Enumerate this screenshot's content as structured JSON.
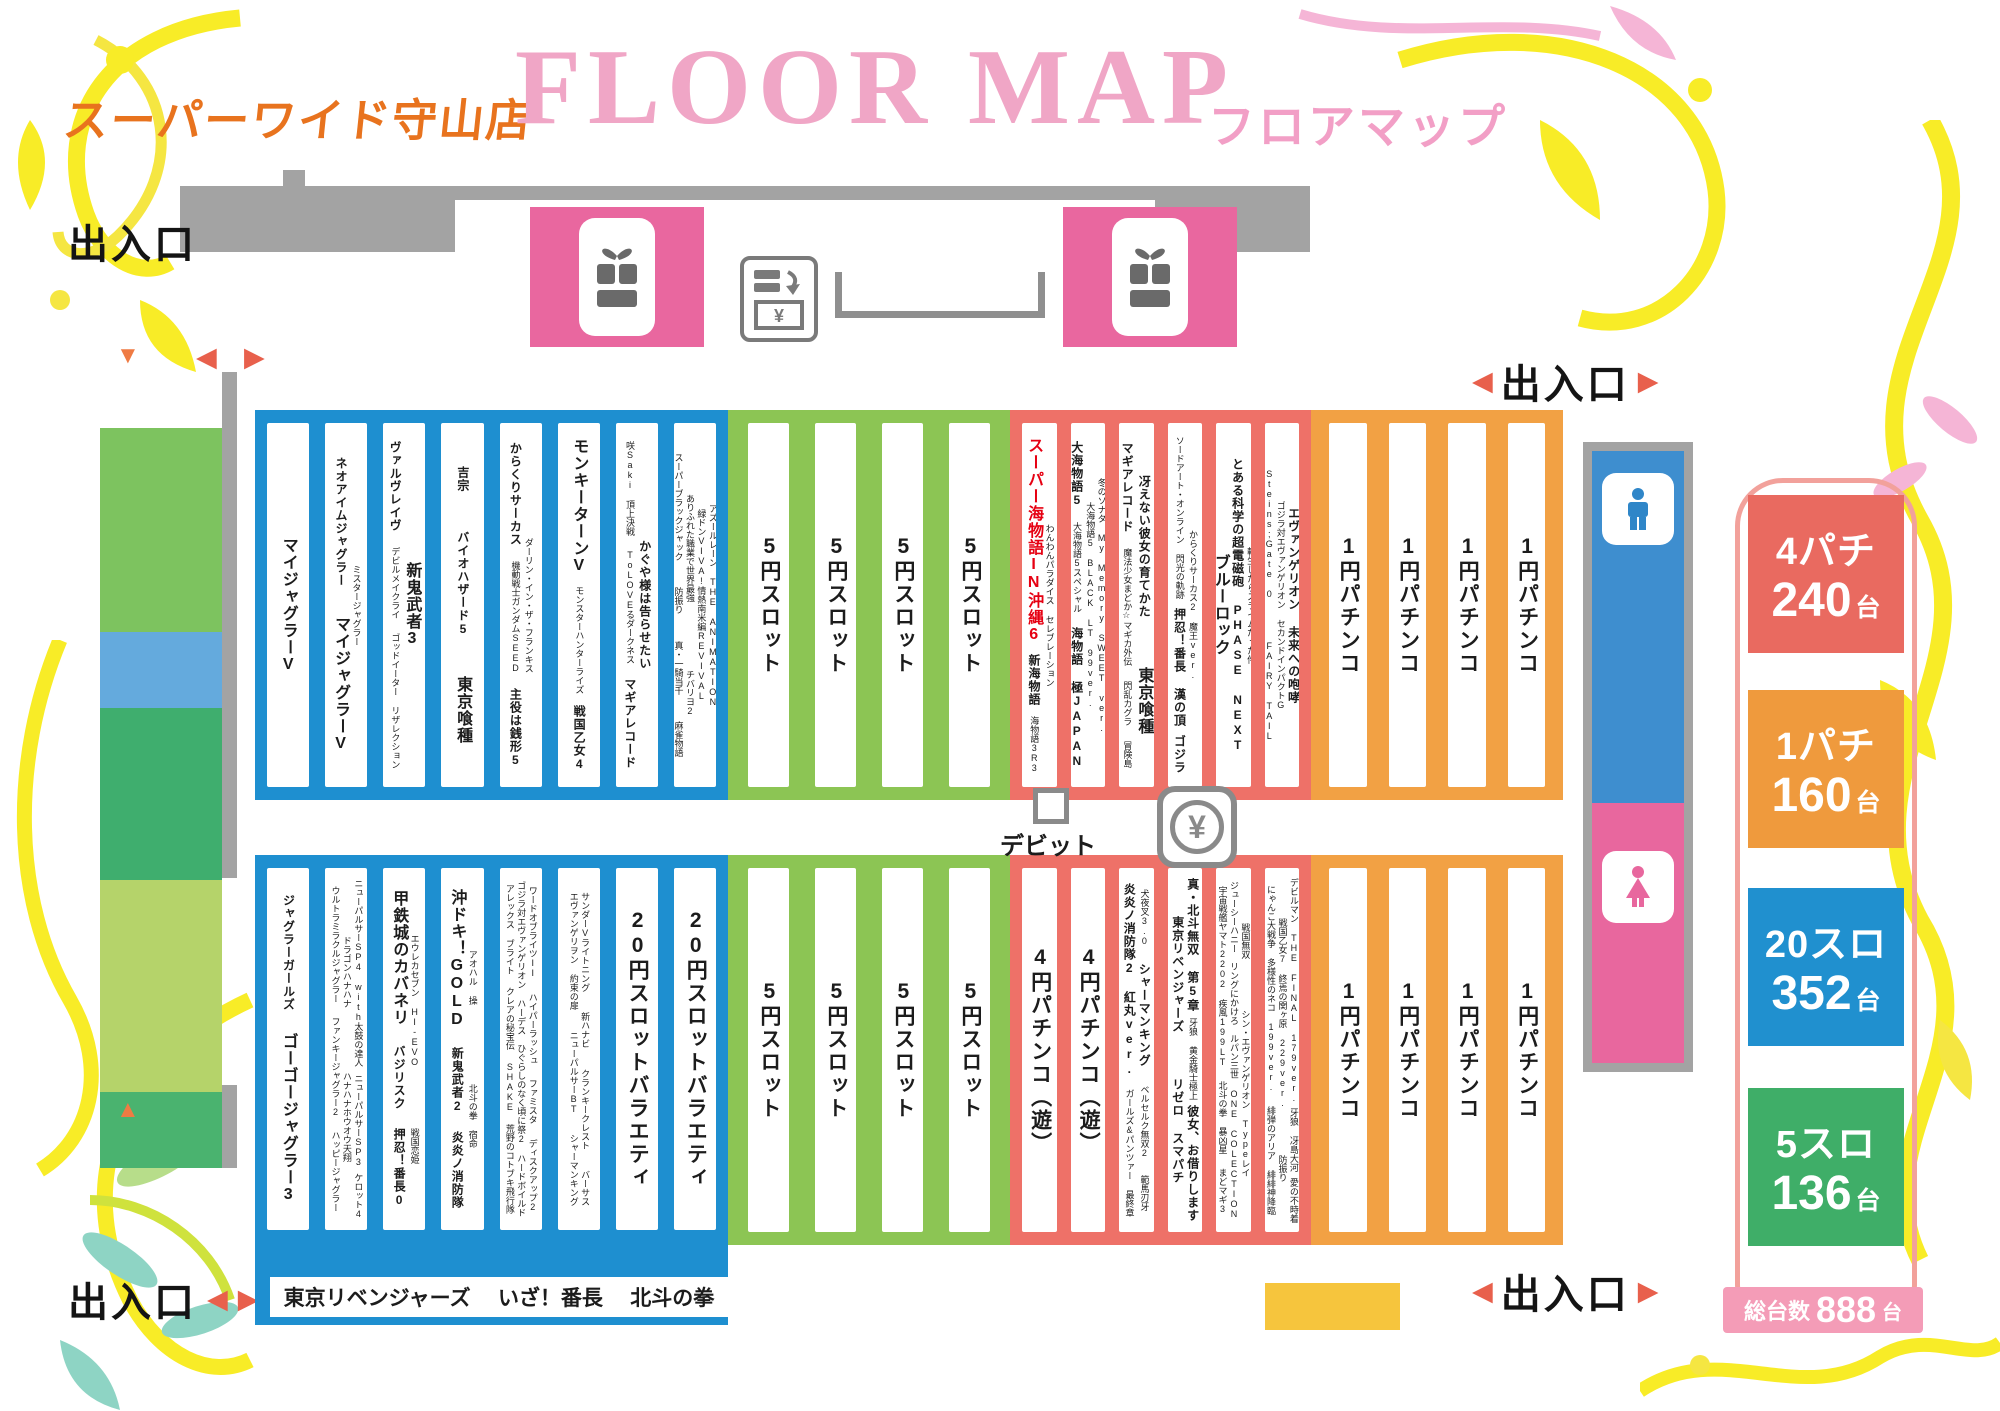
{
  "header": {
    "store": "スーパーワイド守山店",
    "title_en": "FLOOR MAP",
    "title_jp": "フロアマップ"
  },
  "labels": {
    "exit": "出入口",
    "debit": "デビット",
    "yen": "¥",
    "tri_left": "◀",
    "tri_right": "▶",
    "tri_up": "▲",
    "tri_down": "▼"
  },
  "colors": {
    "slot20": "#1e8fd0",
    "slot5": "#8cc554",
    "pachi4": "#ee7168",
    "pachi1": "#f2a144",
    "pink": "#e9679f",
    "wall": "#a3a3a3",
    "accent_red": "#e60012"
  },
  "bottom_strip": {
    "labels": [
      "東京リベンジャーズ",
      "いざ！番長",
      "北斗の拳"
    ]
  },
  "legend": {
    "items": [
      {
        "label": "4パチ",
        "count": "240",
        "unit": "台",
        "color": "#e96a60",
        "y": 495
      },
      {
        "label": "1パチ",
        "count": "160",
        "unit": "台",
        "color": "#ef9a3d",
        "y": 690
      },
      {
        "label": "20スロ",
        "count": "352",
        "unit": "台",
        "color": "#2090cf",
        "y": 888
      },
      {
        "label": "5スロ",
        "count": "136",
        "unit": "台",
        "color": "#3fae68",
        "y": 1088
      }
    ],
    "total_label": "総台数",
    "total_count": "888",
    "total_unit": "台"
  },
  "sections": [
    {
      "id": "slot20-top",
      "color": "#1e8fd0",
      "x": 255,
      "y": 410,
      "w": 473,
      "h": 390,
      "gap": 16,
      "px": 12,
      "columns": [
        [
          {
            "t": "マイジャグラーV",
            "s": "L"
          }
        ],
        [
          {
            "t": "ネオアイムジャグラー",
            "s": "M"
          },
          {
            "t": "マイジャグラーV",
            "s": "L"
          },
          {
            "t": "ミスタージャグラー",
            "s": "S"
          }
        ],
        [
          {
            "t": "ヴァルヴレイヴ",
            "s": "M"
          },
          {
            "t": "デビルメイクライ",
            "s": "S"
          },
          {
            "t": "ゴッドイーター リザレクション",
            "s": "S"
          },
          {
            "t": "新鬼武者3",
            "s": "L"
          }
        ],
        [
          {
            "t": "吉宗",
            "s": "M"
          },
          {
            "t": "バイオハザード5",
            "s": "M"
          },
          {
            "t": "東京喰種",
            "s": "L"
          }
        ],
        [
          {
            "t": "からくりサーカス",
            "s": "M"
          },
          {
            "t": "機動戦士ガンダムSEED",
            "s": "S"
          },
          {
            "t": "主役は銭形5",
            "s": "M"
          },
          {
            "t": "ダーリン・イン・ザ・フランキス",
            "s": "S"
          }
        ],
        [
          {
            "t": "モンキーターンV",
            "s": "L"
          },
          {
            "t": "モンスターハンターライズ",
            "s": "S"
          },
          {
            "t": "戦国乙女4",
            "s": "M"
          }
        ],
        [
          {
            "t": "咲Saki 頂上決戦",
            "s": "S"
          },
          {
            "t": "ToLOVEるダークネス",
            "s": "S"
          },
          {
            "t": "マギアレコード",
            "s": "M"
          },
          {
            "t": "かぐや様は告らせたい",
            "s": "M"
          }
        ],
        [
          {
            "t": "スーパーブラックジャック",
            "s": "S"
          },
          {
            "t": "防振り",
            "s": "S"
          },
          {
            "t": "真・一騎当千",
            "s": "S"
          },
          {
            "t": "麻雀物語",
            "s": "S"
          },
          {
            "t": "ありふれた職業で世界最強",
            "s": "S"
          },
          {
            "t": "チバリヨ2",
            "s": "S"
          },
          {
            "t": "緑ドンVIVA!情熱南米編REVIVAL",
            "s": "S"
          },
          {
            "t": "アズールレーン THE ANIMATION",
            "s": "S"
          }
        ]
      ]
    },
    {
      "id": "slot5-top",
      "color": "#8cc554",
      "x": 728,
      "y": 410,
      "w": 282,
      "h": 390,
      "gap": 26,
      "px": 20,
      "columns": [
        [
          {
            "t": "5円スロット",
            "s": "XL"
          }
        ],
        [
          {
            "t": "5円スロット",
            "s": "XL"
          }
        ],
        [
          {
            "t": "5円スロット",
            "s": "XL"
          }
        ],
        [
          {
            "t": "5円スロット",
            "s": "XL"
          }
        ]
      ]
    },
    {
      "id": "pachi4-top",
      "color": "#ee7168",
      "x": 1010,
      "y": 410,
      "w": 301,
      "h": 390,
      "gap": 14,
      "px": 12,
      "columns": [
        [
          {
            "t": "スーパー海物語IN沖縄6",
            "s": "L",
            "c": "#e60012"
          },
          {
            "t": "新海物語",
            "s": "M"
          },
          {
            "t": "海物語3R3",
            "s": "S"
          },
          {
            "t": "わんわんパラダイス セレブレーション",
            "s": "S"
          }
        ],
        [
          {
            "t": "大海物語5",
            "s": "M"
          },
          {
            "t": "大海物語5スペシャル",
            "s": "S"
          },
          {
            "t": "海物語 極JAPAN",
            "s": "M"
          },
          {
            "t": "大海物語5 BLACK LT 99ver.",
            "s": "S"
          },
          {
            "t": "冬のソナタ My Memory SWEET ver.",
            "s": "S"
          }
        ],
        [
          {
            "t": "マギアレコード",
            "s": "M"
          },
          {
            "t": "魔法少女まどか☆マギカ外伝",
            "s": "S"
          },
          {
            "t": "閃乱カグラ",
            "s": "S"
          },
          {
            "t": "冒険島",
            "s": "S"
          },
          {
            "t": "冴えない彼女の育てかた",
            "s": "M"
          },
          {
            "t": "東京喰種",
            "s": "L"
          }
        ],
        [
          {
            "t": "ソードアート・オンライン 閃光の軌跡",
            "s": "S"
          },
          {
            "t": "押忍！番長 漢の頂",
            "s": "M"
          },
          {
            "t": "ゴジラ",
            "s": "M"
          },
          {
            "t": "からくりサーカス2 魔王ver.",
            "s": "S"
          }
        ],
        [
          {
            "t": "ブルーロック",
            "s": "L"
          },
          {
            "t": "とある科学の超電磁砲 PHASE NEXT",
            "s": "M"
          },
          {
            "t": "転生したらスライムだった件",
            "s": "S"
          }
        ],
        [
          {
            "t": "Steins;Gate 0",
            "s": "S"
          },
          {
            "t": "FAIRY TAIL",
            "s": "S"
          },
          {
            "t": "ゴジラ対エヴァンゲリオン セカンドインパクトG",
            "s": "S"
          },
          {
            "t": "エヴァンゲリオン 未来への咆哮",
            "s": "M"
          }
        ]
      ]
    },
    {
      "id": "pachi1-top",
      "color": "#f2a144",
      "x": 1311,
      "y": 410,
      "w": 252,
      "h": 390,
      "gap": 22,
      "px": 18,
      "columns": [
        [
          {
            "t": "1円パチンコ",
            "s": "XL"
          }
        ],
        [
          {
            "t": "1円パチンコ",
            "s": "XL"
          }
        ],
        [
          {
            "t": "1円パチンコ",
            "s": "XL"
          }
        ],
        [
          {
            "t": "1円パチンコ",
            "s": "XL"
          }
        ]
      ]
    },
    {
      "id": "slot20-bottom",
      "color": "#1e8fd0",
      "x": 255,
      "y": 855,
      "w": 473,
      "h": 470,
      "gap": 16,
      "px": 12,
      "pb": 95,
      "columns": [
        [
          {
            "t": "ジャグラーガールズ",
            "s": "M"
          },
          {
            "t": "ゴーゴージャグラー3",
            "s": "L"
          }
        ],
        [
          {
            "t": "ウルトラミラクルジャグラー",
            "s": "S"
          },
          {
            "t": "ファンキージャグラー2",
            "s": "S"
          },
          {
            "t": "ハッピージャグラー",
            "s": "S"
          },
          {
            "t": "ドラゴンハナハナ",
            "s": "S"
          },
          {
            "t": "ハナハナホウオウ天翔",
            "s": "S"
          },
          {
            "t": "ニューパルサーSP4 with太鼓の達人",
            "s": "S"
          },
          {
            "t": "ニューパルサーSP3",
            "s": "S"
          },
          {
            "t": "ケロット4",
            "s": "S"
          }
        ],
        [
          {
            "t": "甲鉄城のカバネリ",
            "s": "L"
          },
          {
            "t": "バジリスク",
            "s": "M"
          },
          {
            "t": "押忍！番長0",
            "s": "M"
          },
          {
            "t": "エウレカセブン HI-EVO",
            "s": "S"
          },
          {
            "t": "戦国恋姫",
            "s": "S"
          }
        ],
        [
          {
            "t": "沖ドキ！GOLD",
            "s": "L"
          },
          {
            "t": "新鬼武者2",
            "s": "M"
          },
          {
            "t": "炎炎ノ消防隊",
            "s": "M"
          },
          {
            "t": "アオハル 操",
            "s": "S"
          },
          {
            "t": "北斗の拳 宿命",
            "s": "S"
          }
        ],
        [
          {
            "t": "アレックス ブライト",
            "s": "S"
          },
          {
            "t": "クレアの秘宝伝",
            "s": "S"
          },
          {
            "t": "SHAKE",
            "s": "S"
          },
          {
            "t": "荒野のコトブキ飛行隊",
            "s": "S"
          },
          {
            "t": "ゴジラ対エヴァンゲリオン",
            "s": "S"
          },
          {
            "t": "ハーデス",
            "s": "S"
          },
          {
            "t": "ひぐらしのなく頃に祭2",
            "s": "S"
          },
          {
            "t": "ハードボイルド",
            "s": "S"
          },
          {
            "t": "ワードオブライツII",
            "s": "S"
          },
          {
            "t": "ハイパーラッシュ",
            "s": "S"
          },
          {
            "t": "ファミスタ",
            "s": "S"
          },
          {
            "t": "ディスクアップ2",
            "s": "S"
          }
        ],
        [
          {
            "t": "エヴァンゲリヲン 約束の扉",
            "s": "S"
          },
          {
            "t": "ニューパルサーBT",
            "s": "S"
          },
          {
            "t": "シャーマンキング",
            "s": "S"
          },
          {
            "t": "サンダーVライトニング",
            "s": "S"
          },
          {
            "t": "新ハナビ",
            "s": "S"
          },
          {
            "t": "クランキークレスト",
            "s": "S"
          },
          {
            "t": "バーサス",
            "s": "S"
          }
        ],
        [
          {
            "t": "20円スロットバラエティ",
            "s": "XL"
          }
        ],
        [
          {
            "t": "20円スロットバラエティ",
            "s": "XL"
          }
        ]
      ]
    },
    {
      "id": "slot5-bottom",
      "color": "#8cc554",
      "x": 728,
      "y": 855,
      "w": 282,
      "h": 390,
      "gap": 26,
      "px": 20,
      "columns": [
        [
          {
            "t": "5円スロット",
            "s": "XL"
          }
        ],
        [
          {
            "t": "5円スロット",
            "s": "XL"
          }
        ],
        [
          {
            "t": "5円スロット",
            "s": "XL"
          }
        ],
        [
          {
            "t": "5円スロット",
            "s": "XL"
          }
        ]
      ]
    },
    {
      "id": "pachi4-bottom",
      "color": "#ee7168",
      "x": 1010,
      "y": 855,
      "w": 301,
      "h": 390,
      "gap": 14,
      "px": 12,
      "columns": [
        [
          {
            "t": "4円パチンコ（遊）",
            "s": "XL"
          }
        ],
        [
          {
            "t": "4円パチンコ（遊）",
            "s": "XL"
          }
        ],
        [
          {
            "t": "炎炎ノ消防隊2 紅丸ver.",
            "s": "M"
          },
          {
            "t": "ガールズ&パンツァー 最終章",
            "s": "S"
          },
          {
            "t": "犬夜叉3.0",
            "s": "S"
          },
          {
            "t": "シャーマンキング",
            "s": "M"
          },
          {
            "t": "ベルセルク無双2",
            "s": "S"
          },
          {
            "t": "範馬刃牙",
            "s": "S"
          }
        ],
        [
          {
            "t": "東京リベンジャーズ",
            "s": "M"
          },
          {
            "t": "リゼロ スマパチ",
            "s": "M"
          },
          {
            "t": "真・北斗無双 第5章",
            "s": "M"
          },
          {
            "t": "牙狼 黄金騎士極上",
            "s": "S"
          },
          {
            "t": "彼女、お借りします",
            "s": "M"
          }
        ],
        [
          {
            "t": "宇宙戦艦ヤマト2202 疾風199LT",
            "s": "S"
          },
          {
            "t": "北斗の拳 暴凶星",
            "s": "S"
          },
          {
            "t": "まどマギ3",
            "s": "S"
          },
          {
            "t": "ジューシーハニー",
            "s": "S"
          },
          {
            "t": "リングにかけろ",
            "s": "S"
          },
          {
            "t": "ルパン三世 ONE COLECTION",
            "s": "S"
          },
          {
            "t": "戦国無双",
            "s": "S"
          },
          {
            "t": "シン・エヴァンゲリオン Typeレイ",
            "s": "S"
          }
        ],
        [
          {
            "t": "炎炎ノ消防隊",
            "s": "S"
          },
          {
            "t": "冬のソナタ My Memory 199LT",
            "s": "S"
          },
          {
            "t": "真・一騎当千",
            "s": "S"
          },
          {
            "t": "にゃんこ大戦争 多様性のネコ 199ver.",
            "s": "S"
          },
          {
            "t": "緋弾のアリア 緋緋神降臨",
            "s": "S"
          },
          {
            "t": "戦国乙女7 終焉の関ヶ原 229ver.",
            "s": "S"
          },
          {
            "t": "防振り",
            "s": "S"
          },
          {
            "t": "デビルマン THE FINAL 179ver.",
            "s": "S"
          },
          {
            "t": "牙狼 冴島大河",
            "s": "S"
          },
          {
            "t": "愛の不時着",
            "s": "S"
          },
          {
            "t": "真・花の慶次",
            "s": "S"
          }
        ]
      ]
    },
    {
      "id": "pachi1-bottom",
      "color": "#f2a144",
      "x": 1311,
      "y": 855,
      "w": 252,
      "h": 390,
      "gap": 22,
      "px": 18,
      "columns": [
        [
          {
            "t": "1円パチンコ",
            "s": "XL"
          }
        ],
        [
          {
            "t": "1円パチンコ",
            "s": "XL"
          }
        ],
        [
          {
            "t": "1円パチンコ",
            "s": "XL"
          }
        ],
        [
          {
            "t": "1円パチンコ",
            "s": "XL"
          }
        ]
      ]
    }
  ]
}
